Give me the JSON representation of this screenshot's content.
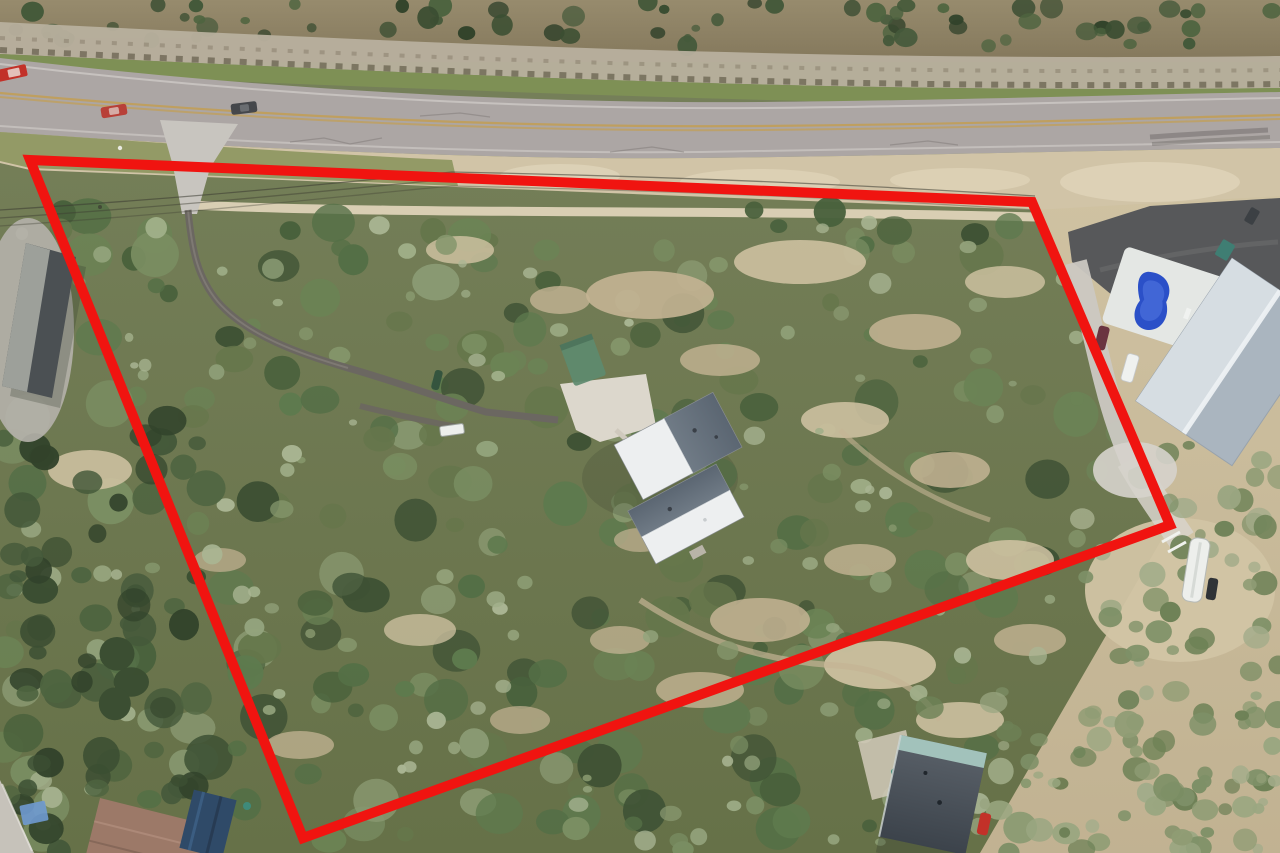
{
  "meta": {
    "description": "Aerial drone photograph of a large wooded rural lot outlined in red, bordered by a two-lane highway at top, with a metal-roof house at center, a curved driveway, and neighboring properties featuring a pool, a silver metal building, an RV trailer and small houses at the bottom corners.",
    "image_type": "aerial-photograph",
    "visible_text": ""
  },
  "boundary": {
    "label": "property-boundary-outline",
    "color": "#f01410",
    "stroke_width": 10,
    "points": "30,160 1032,202 1170,525 303,838"
  },
  "palette": {
    "base-olive1": "#77815b",
    "base-olive2": "#667148",
    "scrub1": "#978b6d",
    "scrub2": "#84785c",
    "rock-light": "#b8b09e",
    "rock-dark": "#56503e",
    "grass": "#7e9055",
    "road": "#aca6a4",
    "road-dark": "#989290",
    "yellow-line": "#c19f58",
    "white-line": "#d9d5d2",
    "shoulder-green": "#8d9661",
    "shoulder-tan": "#d1c4a7",
    "caliche": "#ded3b8",
    "apron": "#c8c5bf",
    "drive-dark": "#6b6761",
    "pad": "#dcd7cc",
    "roof-white": "#edeff0",
    "roof-slate": "#707b86",
    "roof-slate2": "#5b6672",
    "green-roof": "#5d8a6f",
    "leftbldg-dark": "#4b5053",
    "leftbldg-light": "#9da09a",
    "pavement": "#b5b1ab",
    "lot-asphalt": "#57585a",
    "silver1": "#d6dde2",
    "silver2": "#aab5bf",
    "ridge-white": "#eef2f4",
    "pool-pad": "#e4e7e4",
    "pool-blue": "#2b50c8",
    "pool-blue2": "#4a6edb",
    "rv-white": "#edefec",
    "h2-roof1": "#5a6169",
    "h2-roof2": "#3c434b",
    "porch-teal": "#a7c7c0",
    "h3-roof": "#9c7968",
    "h3-blue": "#2f4a68",
    "tarp": "#6f9ad2",
    "car-red": "#c23129",
    "car-dark": "#45474b",
    "car-maroon": "#6a3440",
    "car-white": "#eff1ef",
    "wire": "#3b3b31",
    "boundary-red": "#f01410",
    "tan1": "#c4b494",
    "tan2": "#d2c4a4",
    "shadow": "#2c3226"
  },
  "texture": {
    "tree_colors": [
      "#3e5134",
      "#49613c",
      "#546f46",
      "#5e7a4e",
      "#6b8355",
      "#7a8e62",
      "#8a9a72",
      "#65764b"
    ],
    "tree_dark_colors": [
      "#32432b",
      "#3b4e32",
      "#44593a",
      "#4e6440"
    ],
    "shrub_colors": [
      "#7e9067",
      "#8f9c74",
      "#9aa681",
      "#6d8156",
      "#a3ac8a"
    ],
    "highlight_colors": [
      "#93a37c",
      "#9fae88",
      "#aab694",
      "#87986e"
    ]
  },
  "objects": [
    {
      "name": "highway",
      "description": "Two-lane gray asphalt highway with faded double yellow center line running along the top of the frame"
    },
    {
      "name": "rock-cut-ridge",
      "description": "Limestone rock ledge and brown brush bank above the highway"
    },
    {
      "name": "property-boundary",
      "description": "Thick red quadrilateral outline marking the wooded lot"
    },
    {
      "name": "main-house",
      "description": "L-shaped house with half-white, half-gray metal roofs at the center of the lot"
    },
    {
      "name": "driveway",
      "description": "Narrow paved driveway curving from the highway entrance down to the house"
    },
    {
      "name": "green-outbuilding",
      "description": "Small green-roofed structure northwest of the house"
    },
    {
      "name": "utility-trailer",
      "description": "Small white trailer parked along the drive"
    },
    {
      "name": "left-building",
      "description": "Long gray-roofed building on the adjacent lot at the left edge"
    },
    {
      "name": "neighbor-pool",
      "description": "Blue kidney-shaped swimming pool on a white deck on the right neighbor's lot"
    },
    {
      "name": "neighbor-building",
      "description": "Large silver metal-roof building on the right neighbor's lot"
    },
    {
      "name": "neighbor-parking",
      "description": "Dark asphalt parking area next to the highway on the right"
    },
    {
      "name": "rv-trailer",
      "description": "White RV trailer parked on bare caliche ground at the right"
    },
    {
      "name": "southeast-house",
      "description": "Dark gray shingle-roof house with teal porch roof and red car, bottom right"
    },
    {
      "name": "southwest-house",
      "description": "Brown-roofed house with dark blue carport cover and blue tarp, bottom left"
    },
    {
      "name": "vehicles-on-road",
      "description": "Red truck, red car and dark SUV traveling on the highway"
    },
    {
      "name": "power-lines",
      "description": "Thin overhead utility lines crossing the lot parallel to the road"
    },
    {
      "name": "woodland",
      "description": "Dense oak and juniper woodland with dry tan brush clearings covering the lot"
    }
  ]
}
